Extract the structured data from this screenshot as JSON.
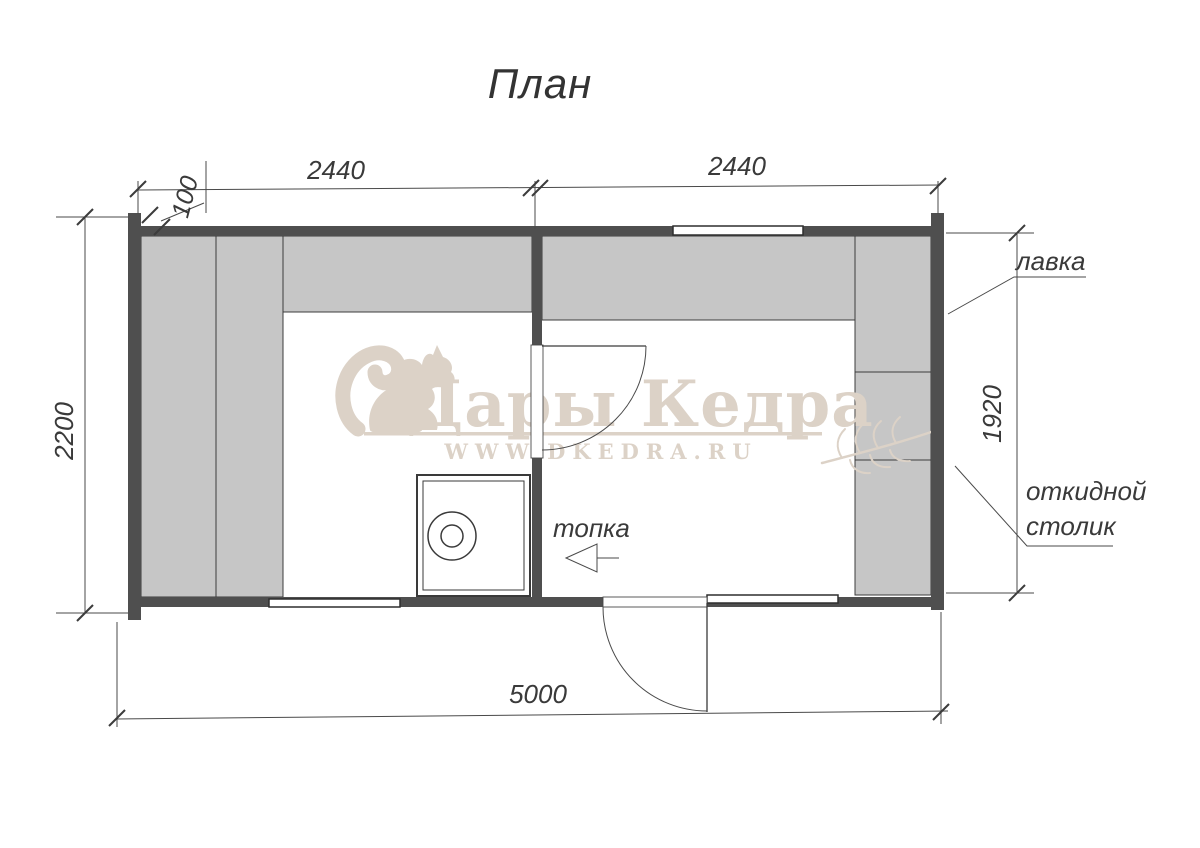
{
  "title": "План",
  "dimensions": {
    "wall_thickness": "100",
    "room_left_width": "2440",
    "room_right_width": "2440",
    "building_depth": "2200",
    "inner_height": "1920",
    "total_length": "5000"
  },
  "labels": {
    "bench": "лавка",
    "folding_table_line1": "откидной",
    "folding_table_line2": "столик",
    "firebox": "топка"
  },
  "watermark": {
    "brand": "Дары Кедра",
    "url": "WWW.DKEDRA.RU"
  },
  "colors": {
    "wall": "#4f4f4f",
    "bench_fill": "#c6c6c6",
    "line": "#4a4a4a",
    "watermark": "#dcd2c7"
  }
}
